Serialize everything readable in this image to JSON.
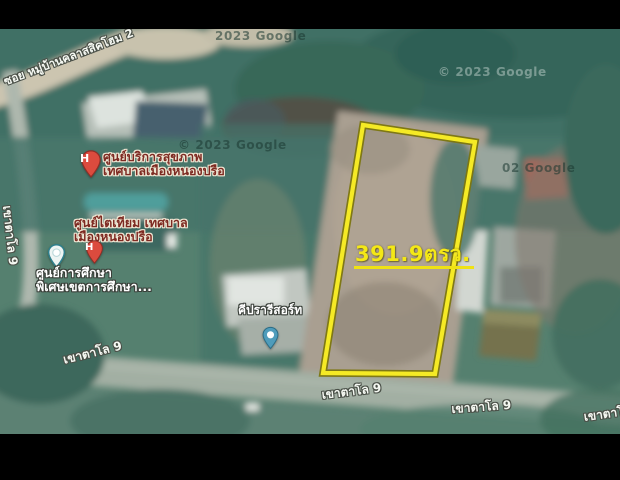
{
  "map": {
    "provider_watermarks": [
      {
        "text": "2023 Google"
      },
      {
        "text": "© 2023 Google"
      },
      {
        "text": "© 2023 Google"
      },
      {
        "text": "02  Google"
      }
    ],
    "land_plot": {
      "area_label": "391.9ตรว.",
      "outline_color": "#f5ea25",
      "outline_edge_color": "#7c760f"
    },
    "roads": [
      {
        "name": "ซอย หมู่บ้านคลาสสิคโฮม 2"
      },
      {
        "name": "เขาตาโล 9"
      },
      {
        "name": "เขาตาโล 9"
      },
      {
        "name": "เขาตาโล 9"
      },
      {
        "name": "เขาตาโล 9"
      },
      {
        "name": "เขาตาโล"
      }
    ],
    "pois": [
      {
        "name_line1": "ศูนย์บริการสุขภาพ",
        "name_line2": "เทศบาลเมืองหนองปรือ",
        "pin_type": "hospital",
        "pin_glyph": "H",
        "pin_color": "#dc4b3e"
      },
      {
        "name_line1": "ศูนย์ไตเทียม เทศบาล",
        "name_line2": "เมืองหนองปรือ",
        "pin_type": "hospital",
        "pin_glyph": "H",
        "pin_color": "#dc4b3e"
      },
      {
        "name_line1": "ศูนย์การศึกษา",
        "name_line2": "พิเศษเขตการศึกษา...",
        "pin_type": "school",
        "pin_color": "#2e7f8c"
      },
      {
        "name_line1": "คีปรารีสอร์ท",
        "name_line2": "",
        "pin_type": "place",
        "pin_color": "#4f9cbb"
      }
    ]
  }
}
